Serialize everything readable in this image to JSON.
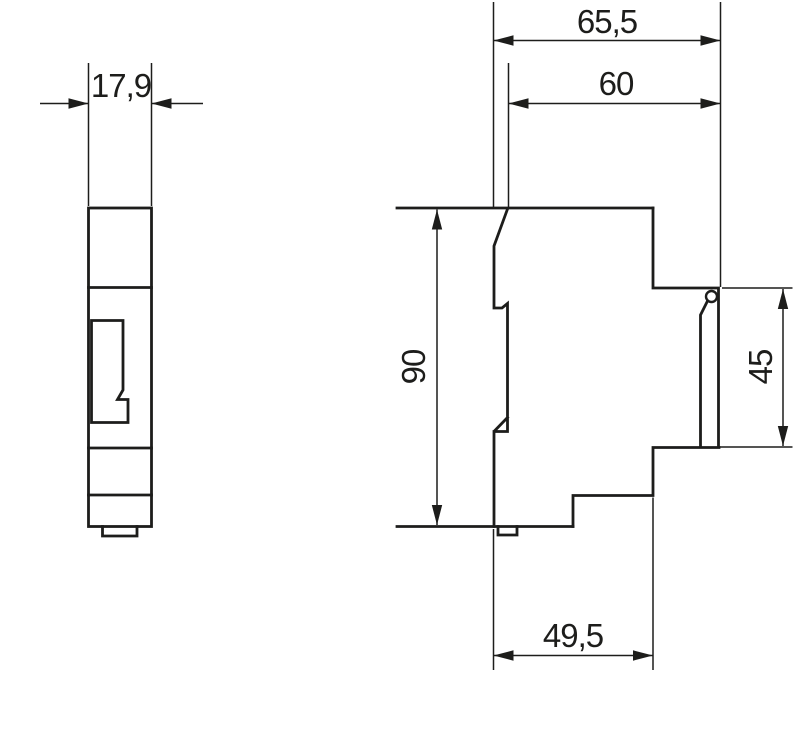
{
  "drawing": {
    "kind": "technical-dimension-drawing",
    "subject": "DIN-rail module, front and side views",
    "units_implied": "mm",
    "colors": {
      "line": "#1d1d1b",
      "background": "#ffffff"
    },
    "views": {
      "front": {
        "name": "front-view",
        "dimensions": {
          "width": {
            "label": "17,9",
            "value": 17.9
          }
        }
      },
      "side": {
        "name": "side-view",
        "dimensions": {
          "overall_depth": {
            "label": "65,5",
            "value": 65.5
          },
          "depth_behind_front": {
            "label": "60",
            "value": 60
          },
          "height": {
            "label": "90",
            "value": 90
          },
          "rear_recess_height": {
            "label": "45",
            "value": 45
          },
          "lower_body_depth": {
            "label": "49,5",
            "value": 49.5
          }
        }
      }
    }
  }
}
